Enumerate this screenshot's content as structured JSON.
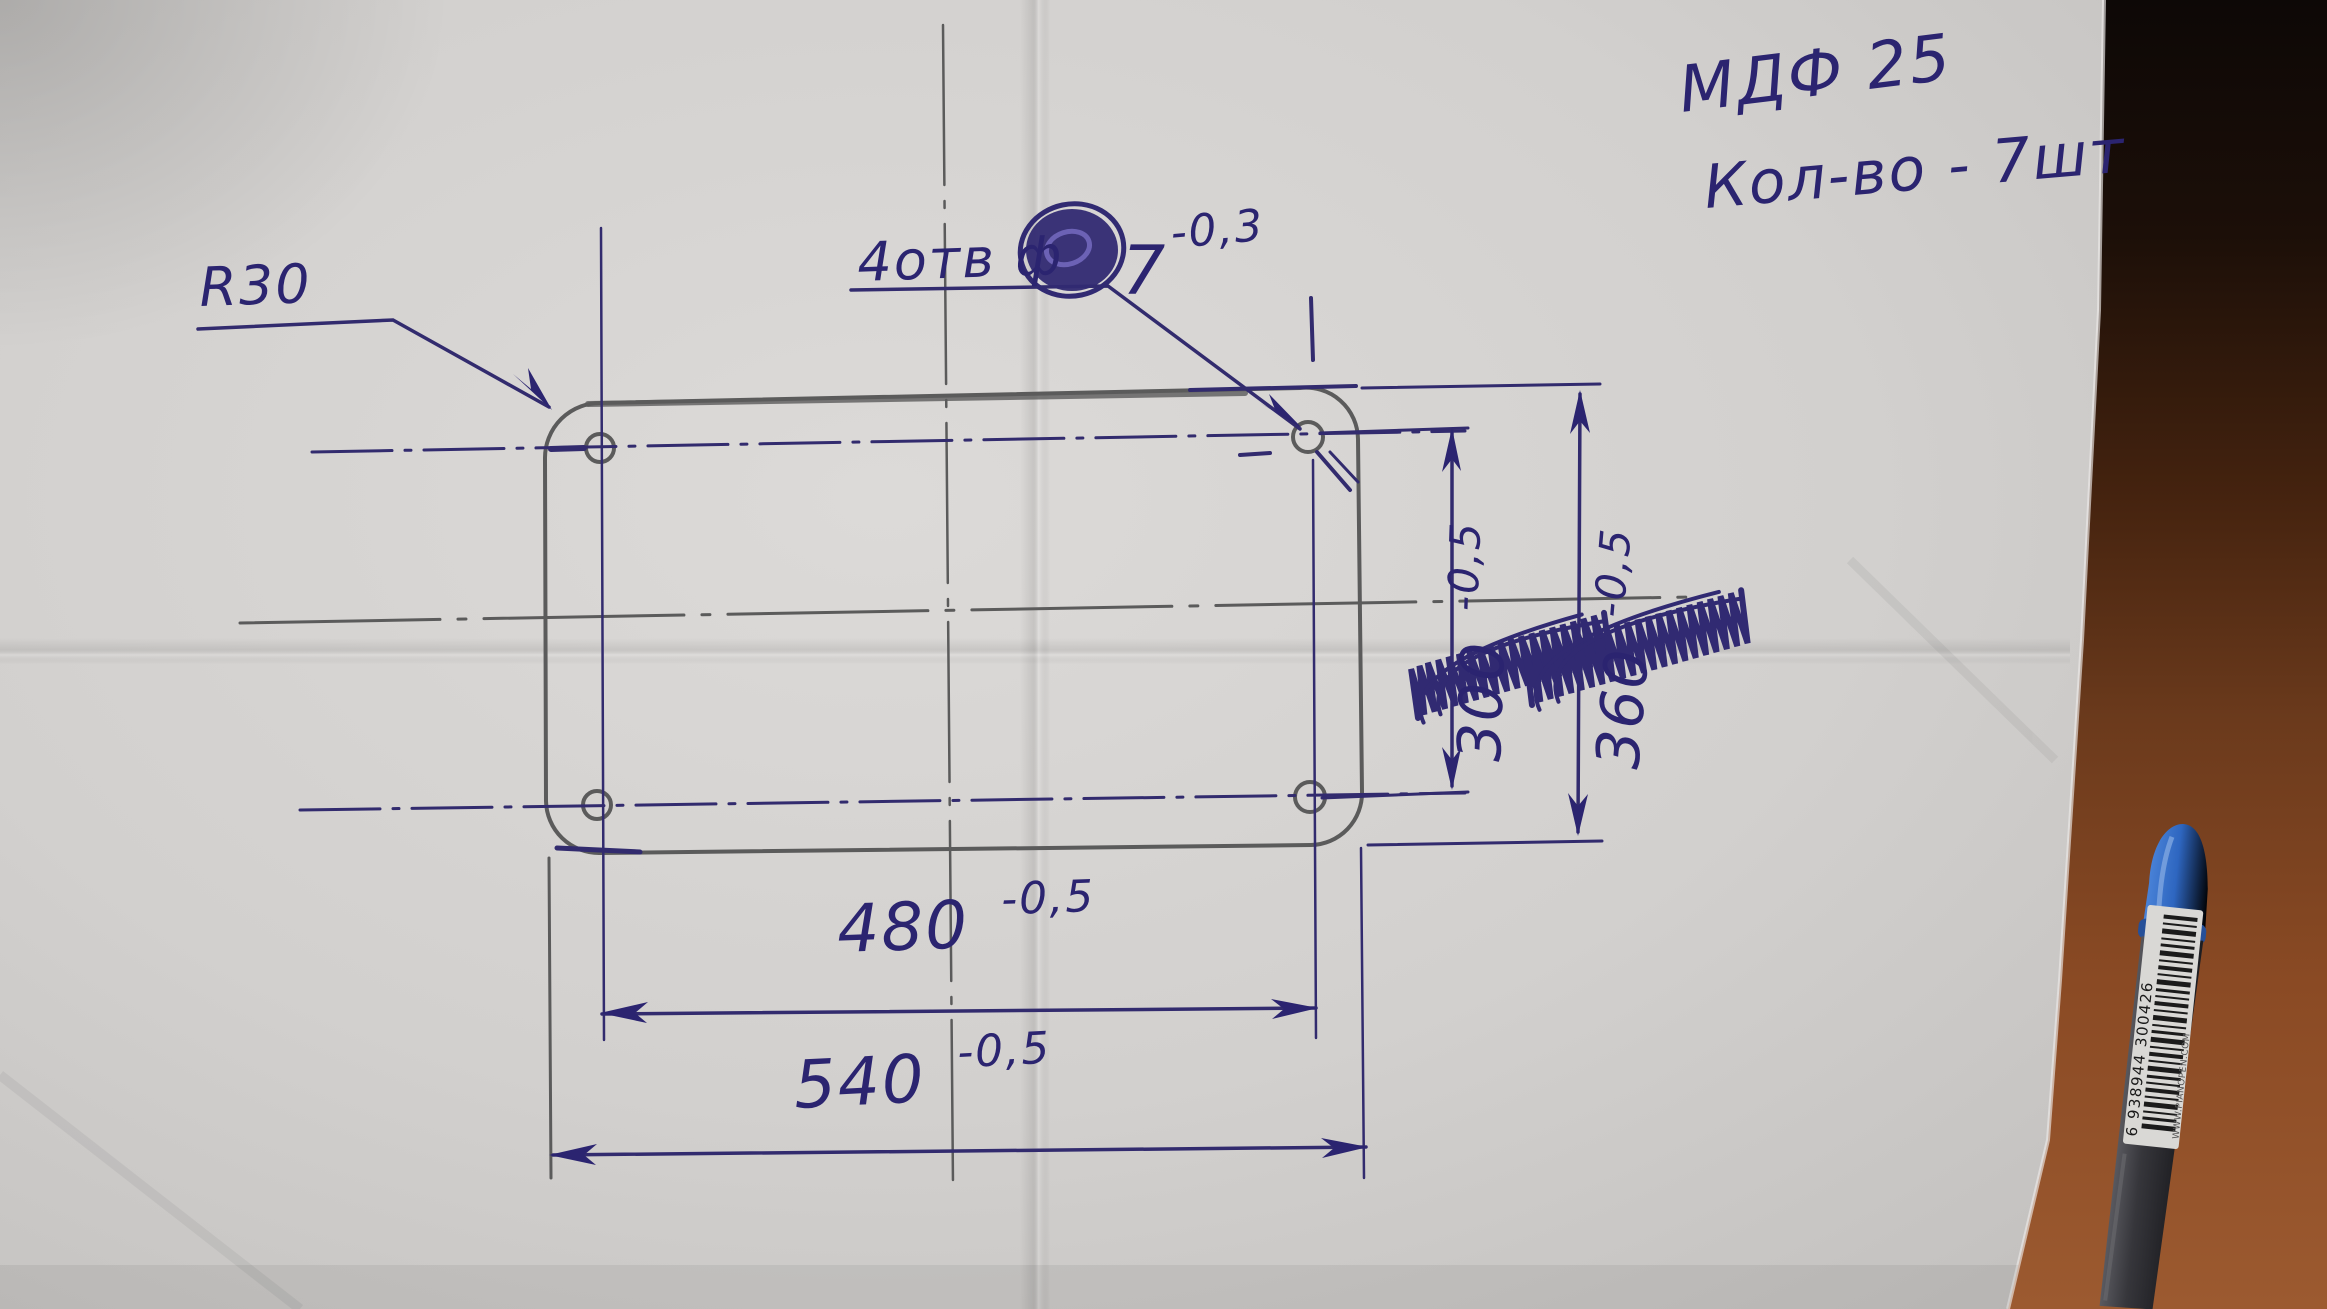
{
  "notes": {
    "material": "МДФ 25",
    "quantity": "Кол-во - 7шт"
  },
  "annotations": {
    "corner_radius_label": "R30",
    "holes_prefix": "4отв ф",
    "holes_value": "7",
    "holes_tolerance": "-0,3"
  },
  "dimensions": {
    "hole_spacing_horizontal": {
      "value": "480",
      "tolerance": "-0,5"
    },
    "plate_width": {
      "value": "540",
      "tolerance": "-0,5"
    },
    "hole_spacing_vertical": {
      "value": "300",
      "tolerance": "-0,5"
    },
    "plate_height": {
      "value": "360",
      "tolerance": "-0,5"
    }
  },
  "pen": {
    "barcode_number": "6 938944 300426",
    "website": "WWW.PIANOPEN.COM"
  },
  "colors": {
    "ink": "#322b6e",
    "ink_text": "#2b2470",
    "pencil": "#5b5b5b",
    "paper": "#d3d1cf",
    "wood": "#8a4a24",
    "pen_cap": "#2e66c0"
  }
}
